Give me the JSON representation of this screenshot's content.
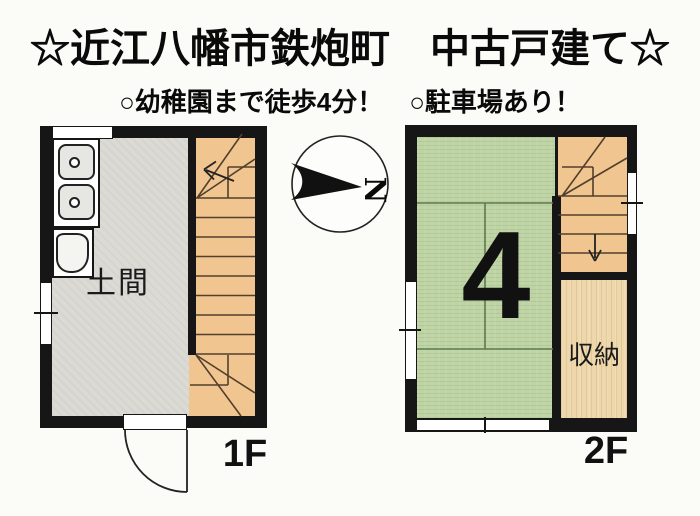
{
  "header": {
    "title": "☆近江八幡市鉄炮町　中古戸建て☆",
    "subtitle": "○幼稚園まで徒歩4分！　○駐車場あり！"
  },
  "compass": {
    "north_label": "N"
  },
  "floor1": {
    "label": "1F",
    "room_labels": {
      "doma": "土間"
    }
  },
  "floor2": {
    "label": "2F",
    "tatami_size_label": "4",
    "room_labels": {
      "storage": "収納"
    }
  },
  "colors": {
    "wall": "#161616",
    "doma_floor": "#DBDAD4",
    "stair_fill": "#F1C590",
    "stair_line": "#52402C",
    "tatami_fill": "#BED4A5",
    "tatami_line": "#5E7A50",
    "storage_wood": "#EED7AB",
    "text": "#0A0A0A"
  }
}
